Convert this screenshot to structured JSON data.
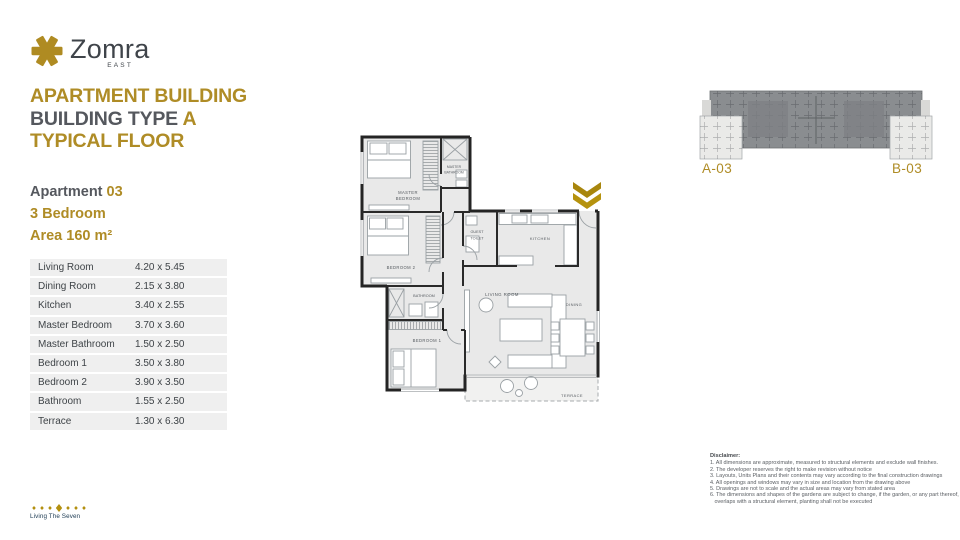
{
  "brand": {
    "name": "Zomra",
    "sub": "EAST",
    "tagline": "Living The Seven"
  },
  "header": {
    "line1": "APARTMENT BUILDING",
    "line2_prefix": "BUILDING TYPE ",
    "line2_highlight": "A",
    "line3": "TYPICAL FLOOR"
  },
  "apartment": {
    "label": "Apartment ",
    "number": "03",
    "type": "3 Bedroom",
    "area": "Area 160 m²"
  },
  "dimensions": {
    "rows": [
      {
        "room": "Living Room",
        "size": "4.20 x 5.45"
      },
      {
        "room": "Dining Room",
        "size": "2.15 x 3.80"
      },
      {
        "room": "Kitchen",
        "size": "3.40 x 2.55"
      },
      {
        "room": "Master Bedroom",
        "size": "3.70 x 3.60"
      },
      {
        "room": "Master Bathroom",
        "size": "1.50 x 2.50"
      },
      {
        "room": "Bedroom 1",
        "size": "3.50 x 3.80"
      },
      {
        "room": "Bedroom 2",
        "size": "3.90 x 3.50"
      },
      {
        "room": "Bathroom",
        "size": "1.55 x 2.50"
      },
      {
        "room": "Terrace",
        "size": "1.30 x 6.30"
      }
    ]
  },
  "floor_plan": {
    "labels": {
      "master_bedroom_1": "MASTER",
      "master_bedroom_2": "BEDROOM",
      "master_bathroom_1": "MASTER",
      "master_bathroom_2": "BATHROOM",
      "bedroom_2": "BEDROOM 2",
      "bathroom": "BATHROOM",
      "bedroom_1": "BEDROOM 1",
      "guest_toilet_1": "GUEST",
      "guest_toilet_2": "TOILET",
      "kitchen": "KITCHEN",
      "living_room": "LIVING ROOM",
      "dining": "DINING",
      "terrace": "TERRACE"
    }
  },
  "key_plan": {
    "unit_a": "A-03",
    "unit_b": "B-03"
  },
  "disclaimer": {
    "title": "Disclaimer:",
    "lines": [
      "1. All dimensions are approximate, measured to structural elements and exclude wall finishes.",
      "2. The developer reserves the right to make revision without notice",
      "3. Layouts, Units Plans and their contents may vary according to the final construction drawings",
      "4. All openings and windows may vary in size and location from the drawing above",
      "5. Drawings are not to scale and the actual areas may vary from stated area",
      "6. The dimensions and shapes of the gardens are subject to change, if the garden, or any part thereof, overlaps with a structural element, planting shall not be executed"
    ]
  },
  "colors": {
    "gold": "#AF8C26",
    "chevron_gold": "#B3900F",
    "heading_gray": "#55585E",
    "text_dark": "#3F444A",
    "keyplan_gray": "#8A8D90",
    "plan_room_fill": "#E9E9E9"
  }
}
